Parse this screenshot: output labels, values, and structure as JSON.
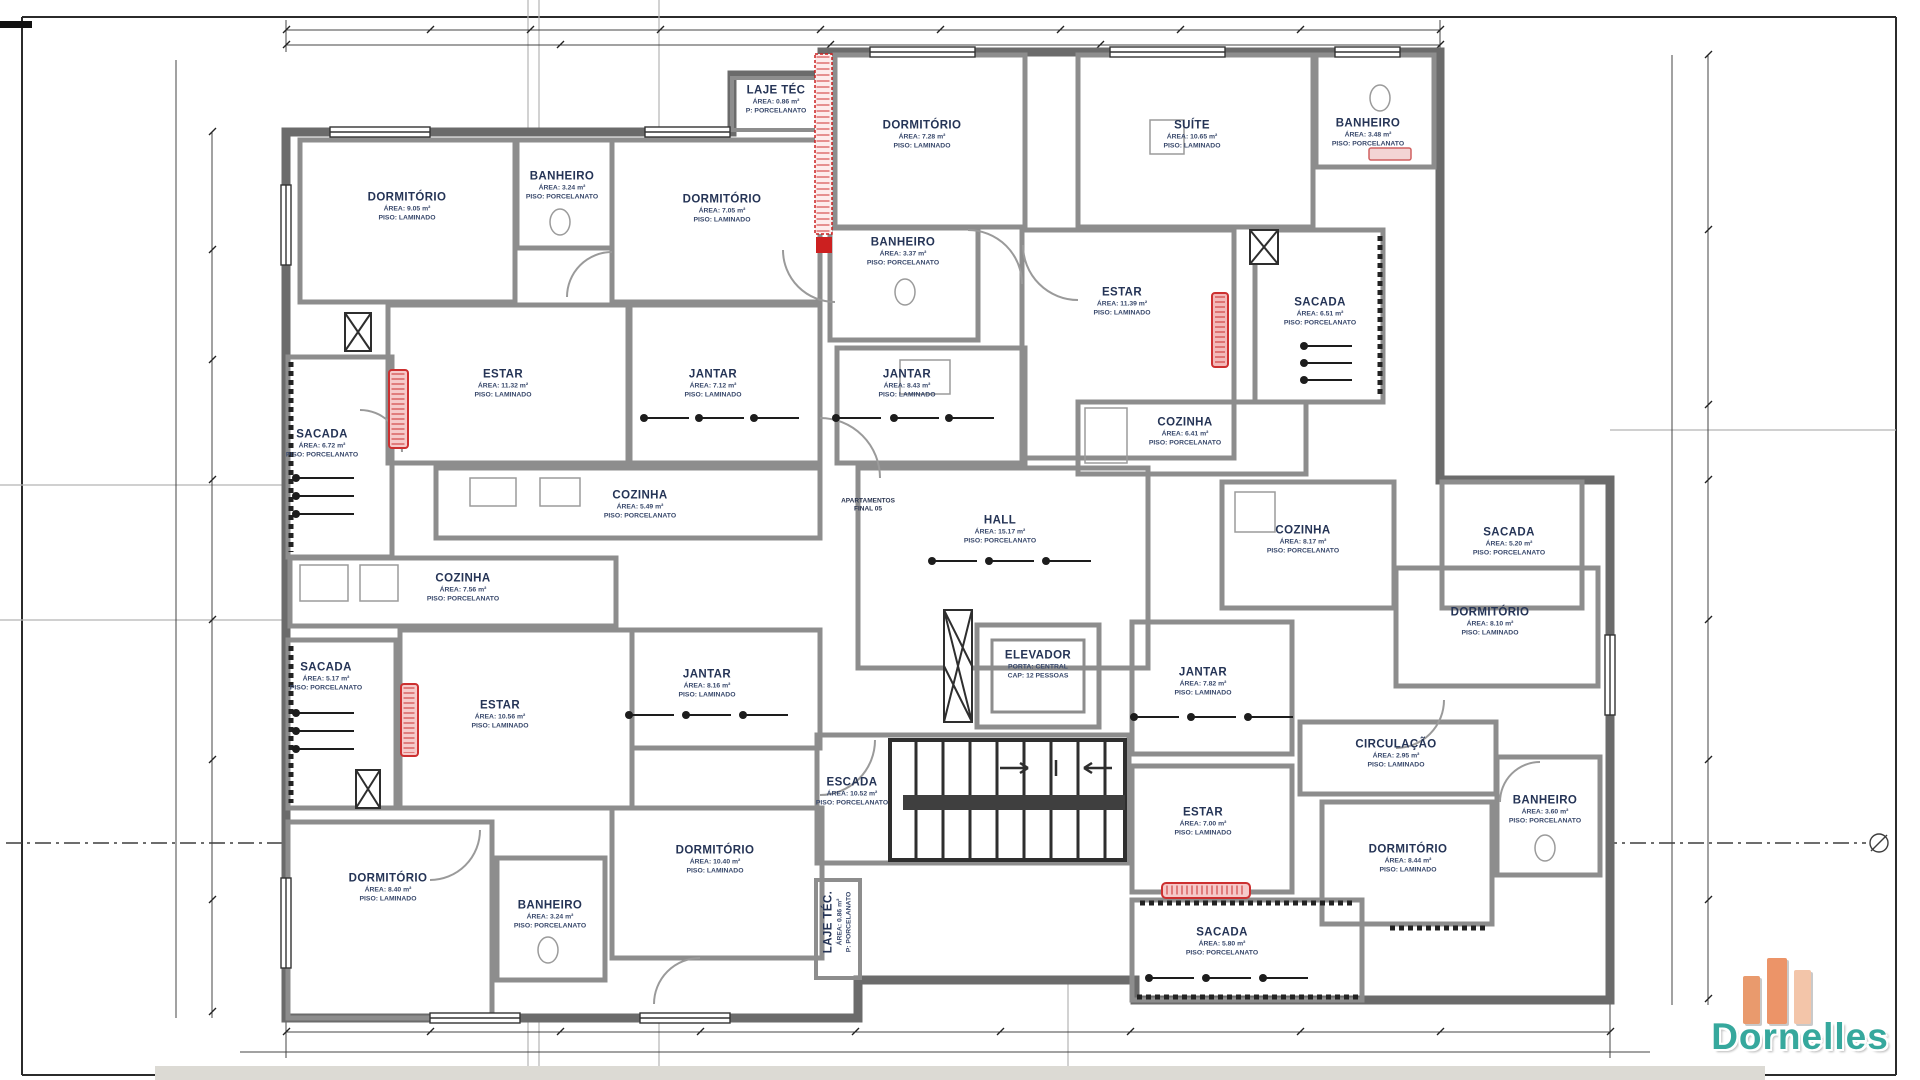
{
  "colors": {
    "wall_gray": "#8d8d8d",
    "accent_red": "#cc2020",
    "label_navy": "#253456",
    "logo_teal": "#36a89d",
    "logo_orange": "#ec9468"
  },
  "rooms": [
    {
      "name": "DORMITÓRIO",
      "line2": "ÁREA: 9.05 m²",
      "line3": "PISO: LAMINADO",
      "x": 407,
      "y": 207,
      "vertical": false
    },
    {
      "name": "BANHEIRO",
      "line2": "ÁREA: 3.24 m²",
      "line3": "PISO: PORCELANATO",
      "x": 562,
      "y": 186,
      "vertical": false
    },
    {
      "name": "DORMITÓRIO",
      "line2": "ÁREA: 7.05 m²",
      "line3": "PISO: LAMINADO",
      "x": 722,
      "y": 209,
      "vertical": false
    },
    {
      "name": "LAJE TÉC",
      "line2": "ÁREA: 0.86 m²",
      "line3": "P: PORCELANATO",
      "x": 776,
      "y": 100,
      "vertical": false
    },
    {
      "name": "DORMITÓRIO",
      "line2": "ÁREA: 7.28 m²",
      "line3": "PISO: LAMINADO",
      "x": 922,
      "y": 135,
      "vertical": false
    },
    {
      "name": "BANHEIRO",
      "line2": "ÁREA: 3.37 m²",
      "line3": "PISO: PORCELANATO",
      "x": 903,
      "y": 252,
      "vertical": false
    },
    {
      "name": "SUÍTE",
      "line2": "ÁREA: 10.65 m²",
      "line3": "PISO: LAMINADO",
      "x": 1192,
      "y": 135,
      "vertical": false
    },
    {
      "name": "BANHEIRO",
      "line2": "ÁREA: 3.48 m²",
      "line3": "PISO: PORCELANATO",
      "x": 1368,
      "y": 133,
      "vertical": false
    },
    {
      "name": "ESTAR",
      "line2": "ÁREA: 11.32 m²",
      "line3": "PISO: LAMINADO",
      "x": 503,
      "y": 384,
      "vertical": false
    },
    {
      "name": "JANTAR",
      "line2": "ÁREA: 7.12 m²",
      "line3": "PISO: LAMINADO",
      "x": 713,
      "y": 384,
      "vertical": false
    },
    {
      "name": "JANTAR",
      "line2": "ÁREA: 8.43 m²",
      "line3": "PISO: LAMINADO",
      "x": 907,
      "y": 384,
      "vertical": false
    },
    {
      "name": "ESTAR",
      "line2": "ÁREA: 11.39 m²",
      "line3": "PISO: LAMINADO",
      "x": 1122,
      "y": 302,
      "vertical": false
    },
    {
      "name": "SACADA",
      "line2": "ÁREA: 6.72 m²",
      "line3": "PISO: PORCELANATO",
      "x": 322,
      "y": 444,
      "vertical": false
    },
    {
      "name": "SACADA",
      "line2": "ÁREA: 6.51 m²",
      "line3": "PISO: PORCELANATO",
      "x": 1320,
      "y": 312,
      "vertical": false
    },
    {
      "name": "COZINHA",
      "line2": "ÁREA: 6.41 m²",
      "line3": "PISO: PORCELANATO",
      "x": 1185,
      "y": 432,
      "vertical": false
    },
    {
      "name": "COZINHA",
      "line2": "ÁREA: 5.49 m²",
      "line3": "PISO: PORCELANATO",
      "x": 640,
      "y": 505,
      "vertical": false
    },
    {
      "name": "HALL",
      "line2": "ÁREA: 15.17 m²",
      "line3": "PISO: PORCELANATO",
      "x": 1000,
      "y": 530,
      "vertical": false
    },
    {
      "name": "COZINHA",
      "line2": "ÁREA: 8.17 m²",
      "line3": "PISO: PORCELANATO",
      "x": 1303,
      "y": 540,
      "vertical": false
    },
    {
      "name": "SACADA",
      "line2": "ÁREA: 5.20 m²",
      "line3": "PISO: PORCELANATO",
      "x": 1509,
      "y": 542,
      "vertical": false
    },
    {
      "name": "COZINHA",
      "line2": "ÁREA: 7.56 m²",
      "line3": "PISO: PORCELANATO",
      "x": 463,
      "y": 588,
      "vertical": false
    },
    {
      "name": "DORMITÓRIO",
      "line2": "ÁREA: 8.10 m²",
      "line3": "PISO: LAMINADO",
      "x": 1490,
      "y": 622,
      "vertical": false
    },
    {
      "name": "SACADA",
      "line2": "ÁREA: 5.17 m²",
      "line3": "PISO: PORCELANATO",
      "x": 326,
      "y": 677,
      "vertical": false
    },
    {
      "name": "JANTAR",
      "line2": "ÁREA: 8.16 m²",
      "line3": "PISO: LAMINADO",
      "x": 707,
      "y": 684,
      "vertical": false
    },
    {
      "name": "ELEVADOR",
      "line2": "PORTA: CENTRAL",
      "line3": "CAP: 12 PESSOAS",
      "x": 1038,
      "y": 665,
      "vertical": false
    },
    {
      "name": "ESTAR",
      "line2": "ÁREA: 10.56 m²",
      "line3": "PISO: LAMINADO",
      "x": 500,
      "y": 715,
      "vertical": false
    },
    {
      "name": "JANTAR",
      "line2": "ÁREA: 7.82 m²",
      "line3": "PISO: LAMINADO",
      "x": 1203,
      "y": 682,
      "vertical": false
    },
    {
      "name": "CIRCULAÇÃO",
      "line2": "ÁREA: 2.95 m²",
      "line3": "PISO: LAMINADO",
      "x": 1396,
      "y": 754,
      "vertical": false
    },
    {
      "name": "ESCADA",
      "line2": "ÁREA: 10.52 m²",
      "line3": "PISO: PORCELANATO",
      "x": 852,
      "y": 792,
      "vertical": false
    },
    {
      "name": "ESTAR",
      "line2": "ÁREA: 7.00 m²",
      "line3": "PISO: LAMINADO",
      "x": 1203,
      "y": 822,
      "vertical": false
    },
    {
      "name": "BANHEIRO",
      "line2": "ÁREA: 3.60 m²",
      "line3": "PISO: PORCELANATO",
      "x": 1545,
      "y": 810,
      "vertical": false
    },
    {
      "name": "DORMITÓRIO",
      "line2": "ÁREA: 8.44 m²",
      "line3": "PISO: LAMINADO",
      "x": 1408,
      "y": 859,
      "vertical": false
    },
    {
      "name": "DORMITÓRIO",
      "line2": "ÁREA: 8.40 m²",
      "line3": "PISO: LAMINADO",
      "x": 388,
      "y": 888,
      "vertical": false
    },
    {
      "name": "BANHEIRO",
      "line2": "ÁREA: 3.24 m²",
      "line3": "PISO: PORCELANATO",
      "x": 550,
      "y": 915,
      "vertical": false
    },
    {
      "name": "DORMITÓRIO",
      "line2": "ÁREA: 10.40 m²",
      "line3": "PISO: LAMINADO",
      "x": 715,
      "y": 860,
      "vertical": false
    },
    {
      "name": "LAJE TÉC.",
      "line2": "ÁREA: 0.86 m²",
      "line3": "P: PORCELANATO",
      "x": 838,
      "y": 922,
      "vertical": true
    },
    {
      "name": "SACADA",
      "line2": "ÁREA: 5.80 m²",
      "line3": "PISO: PORCELANATO",
      "x": 1222,
      "y": 942,
      "vertical": false
    }
  ],
  "annotations": {
    "apartment_note_line1": "APARTAMENTOS",
    "apartment_note_line2": "FINAL 05"
  },
  "logo": {
    "text": "Dornelles"
  }
}
